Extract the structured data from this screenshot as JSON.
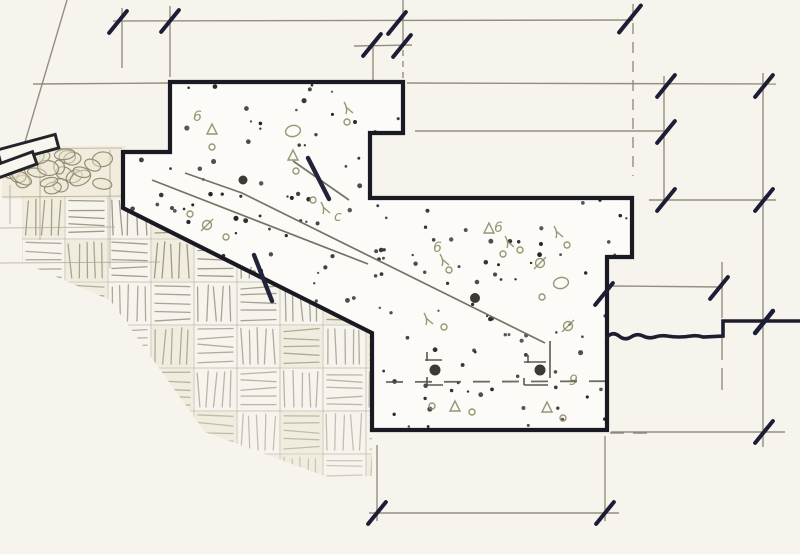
{
  "canvas": {
    "w": 800,
    "h": 554,
    "paper": "#f6f4ed"
  },
  "palette": {
    "heavy": "#1a1a22",
    "tick": "#1d1d36",
    "thin": "#8a8472",
    "pencil": "#aca58e",
    "olive": "#8f8a66",
    "stipple": "#23232a",
    "pebble": "#8c8670",
    "pebbleFill": "#ece5cf",
    "joint": "#6f6a5c",
    "rebar": "#3c3a32",
    "cellFill": "#ece5cd",
    "hatch": "#9b9480",
    "border": "#b3ac96"
  },
  "concrete": {
    "path": "M170,82 H403 V133 H370 V198 H632 V257 H607 V430 H372 V333 L123,208 V152 H170 Z",
    "fill": "#fcfbf7",
    "stroke_width": 4.2
  },
  "break_line": {
    "path": "M607,337 q6,-6 12,-1 t12,1 t12,-1 t12,1 t12,-1 t12,1 t12,-1 t12,1 L723,336 L723,321 L800,321",
    "width": 3.6
  },
  "joint_lines": [
    {
      "path": "M185,173 L242,193 L545,343"
    },
    {
      "path": "M152,180 L368,264"
    },
    {
      "path": "M293,161 L349,200"
    }
  ],
  "thin_lines": [
    {
      "x1": 113,
      "y1": 21,
      "x2": 633,
      "y2": 20
    },
    {
      "x1": 354,
      "y1": 46,
      "x2": 412,
      "y2": 45
    },
    {
      "x1": 33,
      "y1": 84,
      "x2": 169,
      "y2": 83
    },
    {
      "x1": 407,
      "y1": 83,
      "x2": 776,
      "y2": 84
    },
    {
      "x1": 415,
      "y1": 131,
      "x2": 665,
      "y2": 131
    },
    {
      "x1": 649,
      "y1": 200,
      "x2": 776,
      "y2": 200
    },
    {
      "x1": 609,
      "y1": 286,
      "x2": 723,
      "y2": 287
    },
    {
      "x1": 611,
      "y1": 432,
      "x2": 785,
      "y2": 432
    },
    {
      "x1": 369,
      "y1": 513,
      "x2": 619,
      "y2": 513
    },
    {
      "x1": 122,
      "y1": 8,
      "x2": 122,
      "y2": 68
    },
    {
      "x1": 170,
      "y1": 6,
      "x2": 170,
      "y2": 77
    },
    {
      "x1": 373,
      "y1": 45,
      "x2": 373,
      "y2": 80
    },
    {
      "x1": 403,
      "y1": 0,
      "x2": 403,
      "y2": 45
    },
    {
      "x1": 403,
      "y1": 50,
      "x2": 403,
      "y2": 79,
      "dash": "6,5"
    },
    {
      "x1": 633,
      "y1": 4,
      "x2": 633,
      "y2": 176,
      "dash": "11,8"
    },
    {
      "x1": 664,
      "y1": 76,
      "x2": 664,
      "y2": 201
    },
    {
      "x1": 763,
      "y1": 73,
      "x2": 763,
      "y2": 447
    },
    {
      "x1": 722,
      "y1": 262,
      "x2": 722,
      "y2": 318
    },
    {
      "x1": 722,
      "y1": 338,
      "x2": 722,
      "y2": 398,
      "dash": "22,8"
    },
    {
      "x1": 377,
      "y1": 445,
      "x2": 377,
      "y2": 521
    },
    {
      "x1": 605,
      "y1": 436,
      "x2": 605,
      "y2": 521
    },
    {
      "x1": 67,
      "y1": 0,
      "x2": 25,
      "y2": 142
    },
    {
      "x1": 610,
      "y1": 433,
      "x2": 655,
      "y2": 433,
      "dash": "14,9"
    }
  ],
  "pencil_lines": [
    {
      "x1": 0,
      "y1": 149,
      "x2": 122,
      "y2": 148
    },
    {
      "x1": 2,
      "y1": 197,
      "x2": 126,
      "y2": 196
    },
    {
      "x1": 0,
      "y1": 228,
      "x2": 115,
      "y2": 227
    },
    {
      "x1": 0,
      "y1": 263,
      "x2": 160,
      "y2": 262
    },
    {
      "x1": 40,
      "y1": 155,
      "x2": 40,
      "y2": 240
    },
    {
      "x1": 110,
      "y1": 150,
      "x2": 110,
      "y2": 268
    },
    {
      "x1": 10,
      "y1": 185,
      "x2": 10,
      "y2": 224
    }
  ],
  "ticks": [
    {
      "x": 118,
      "y": 22
    },
    {
      "x": 170,
      "y": 21
    },
    {
      "x": 397,
      "y": 23
    },
    {
      "x": 630,
      "y": 19,
      "len": 32
    },
    {
      "x": 372,
      "y": 45
    },
    {
      "x": 402,
      "y": 46
    },
    {
      "x": 666,
      "y": 86
    },
    {
      "x": 764,
      "y": 86
    },
    {
      "x": 666,
      "y": 132
    },
    {
      "x": 666,
      "y": 200
    },
    {
      "x": 764,
      "y": 200
    },
    {
      "x": 604,
      "y": 294
    },
    {
      "x": 719,
      "y": 288
    },
    {
      "x": 764,
      "y": 322,
      "w": 4.6
    },
    {
      "x": 764,
      "y": 432
    },
    {
      "x": 377,
      "y": 513
    },
    {
      "x": 605,
      "y": 513
    }
  ],
  "dowels": [
    {
      "x1": 308,
      "y1": 158,
      "x2": 329,
      "y2": 199
    },
    {
      "x1": 254,
      "y1": 255,
      "x2": 272,
      "y2": 301
    }
  ],
  "planks": [
    {
      "cx": 28,
      "cy": 149,
      "w": 60,
      "h": 14,
      "rot": -15
    },
    {
      "cx": 15,
      "cy": 165,
      "w": 42,
      "h": 13,
      "rot": -20
    }
  ],
  "pebble_zone": {
    "x": 2,
    "y": 146,
    "w": 124,
    "h": 53,
    "count": 26,
    "seed": 11
  },
  "stipple": {
    "count": 150,
    "seed": 5
  },
  "hatch": {
    "origin": [
      22,
      196
    ],
    "cell": 43,
    "cols": 9,
    "rows": 7,
    "seed": 9,
    "clip": "M22,196 L123,196 L123,206 L372,332 L372,476 L330,478 L205,432 L110,300 L22,262 Z"
  },
  "aggregates": [
    {
      "x": 197,
      "y": 116,
      "k": "6"
    },
    {
      "x": 212,
      "y": 130,
      "k": "T"
    },
    {
      "x": 212,
      "y": 147,
      "k": "o"
    },
    {
      "x": 293,
      "y": 131,
      "k": "O"
    },
    {
      "x": 348,
      "y": 108,
      "k": "L"
    },
    {
      "x": 347,
      "y": 122,
      "k": "o"
    },
    {
      "x": 293,
      "y": 156,
      "k": "T"
    },
    {
      "x": 296,
      "y": 171,
      "k": "o"
    },
    {
      "x": 190,
      "y": 214,
      "k": "o"
    },
    {
      "x": 207,
      "y": 225,
      "k": "P"
    },
    {
      "x": 226,
      "y": 237,
      "k": "o"
    },
    {
      "x": 313,
      "y": 200,
      "k": "o"
    },
    {
      "x": 325,
      "y": 208,
      "k": "L"
    },
    {
      "x": 338,
      "y": 216,
      "k": "c"
    },
    {
      "x": 252,
      "y": 273,
      "k": "b"
    },
    {
      "x": 268,
      "y": 289,
      "k": "o"
    },
    {
      "x": 283,
      "y": 298,
      "k": "P"
    },
    {
      "x": 301,
      "y": 309,
      "k": "o"
    },
    {
      "x": 437,
      "y": 247,
      "k": "6"
    },
    {
      "x": 444,
      "y": 260,
      "k": "L"
    },
    {
      "x": 449,
      "y": 270,
      "k": "o"
    },
    {
      "x": 498,
      "y": 227,
      "k": "6"
    },
    {
      "x": 509,
      "y": 242,
      "k": "L"
    },
    {
      "x": 503,
      "y": 254,
      "k": "o"
    },
    {
      "x": 489,
      "y": 229,
      "k": "T"
    },
    {
      "x": 520,
      "y": 250,
      "k": "o"
    },
    {
      "x": 558,
      "y": 232,
      "k": "L"
    },
    {
      "x": 567,
      "y": 245,
      "k": "o"
    },
    {
      "x": 540,
      "y": 263,
      "k": "P"
    },
    {
      "x": 561,
      "y": 283,
      "k": "O"
    },
    {
      "x": 542,
      "y": 297,
      "k": "o"
    },
    {
      "x": 428,
      "y": 319,
      "k": "L"
    },
    {
      "x": 444,
      "y": 327,
      "k": "o"
    },
    {
      "x": 568,
      "y": 326,
      "k": "P"
    },
    {
      "x": 573,
      "y": 380,
      "k": "9"
    },
    {
      "x": 432,
      "y": 406,
      "k": "o"
    },
    {
      "x": 455,
      "y": 407,
      "k": "T"
    },
    {
      "x": 472,
      "y": 412,
      "k": "o"
    },
    {
      "x": 547,
      "y": 408,
      "k": "T"
    },
    {
      "x": 563,
      "y": 418,
      "k": "o"
    }
  ],
  "rebar_dots": [
    {
      "x": 243,
      "y": 180,
      "r": 4.5
    },
    {
      "x": 475,
      "y": 298,
      "r": 5
    },
    {
      "x": 435,
      "y": 370,
      "r": 5.5
    },
    {
      "x": 540,
      "y": 370,
      "r": 5.5
    }
  ],
  "rebar_brackets": [
    {
      "path": "M425,360 H442 M427,352 V361 M427,377 V385 M427,385 H443"
    },
    {
      "path": "M524,362 H546 M528,355 V363 M524,378 V385 M524,385 H548 M550,341 V378"
    }
  ],
  "rebar_dash": {
    "x1": 386,
    "y1": 382,
    "x2": 660,
    "y2": 381,
    "dash": "17,12"
  }
}
